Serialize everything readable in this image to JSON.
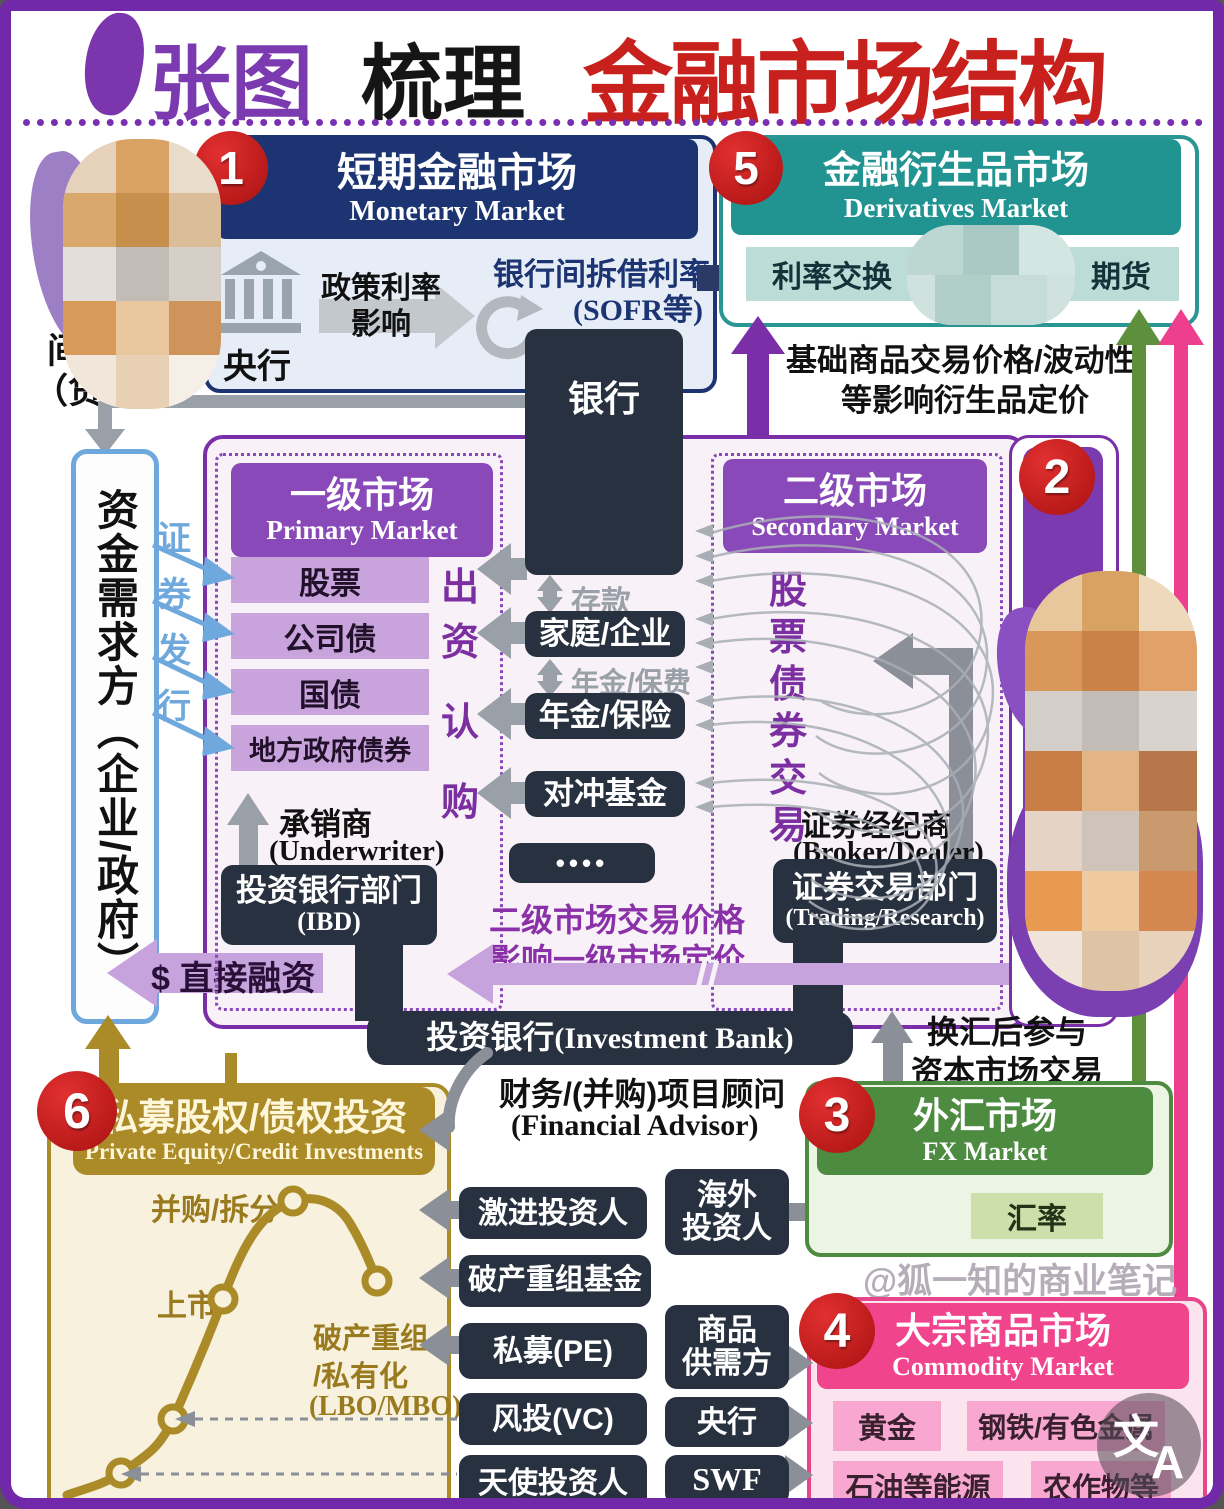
{
  "colors": {
    "frame_purple": "#7229a9",
    "title_red": "#c8201d",
    "title_purple": "#7b3ab0",
    "navy": "#1c3572",
    "teal": "#219492",
    "purple_header": "#8a49b8",
    "deep_purple": "#7b3ab0",
    "badge_red": "#c41d1d",
    "gold": "#ab8a28",
    "green": "#4d8b40",
    "pink": "#f0448c",
    "dark_box": "#28313f",
    "gray_arrow": "#9aa0a8",
    "light_blue": "#6fa8dc",
    "light_purple_arrow": "#c6a3dc"
  },
  "title": {
    "part1": "张图",
    "part2": "梳理",
    "part3": "金融市场结构"
  },
  "monetary": {
    "badge": "1",
    "title_zh": "短期金融市场",
    "title_en": "Monetary Market",
    "central_bank": "央行",
    "policy_line1": "政策利率",
    "policy_line2": "影响",
    "interbank_rate": "银行间拆借利率",
    "interbank_note": "(SOFR等)"
  },
  "bank_box": "银行",
  "derivatives": {
    "badge": "5",
    "title_zh": "金融衍生品市场",
    "title_en": "Derivatives Market",
    "item_irs": "利率交换",
    "item_futures": "期货",
    "note_line1": "基础商品交易价格/波动性",
    "note_line2": "等影响衍生品定价"
  },
  "left_rail": {
    "indirect_line1": "间接融资",
    "indirect_line2": "（贷款）",
    "demand_box": "资金需求方（企业/政府）",
    "issue_chars": [
      "证",
      "券",
      "发",
      "行"
    ],
    "direct_financing": "$ 直接融资"
  },
  "capital": {
    "badge": "2",
    "rail_label": "资本市场",
    "primary": {
      "title_zh": "一级市场",
      "title_en": "Primary Market",
      "instruments": [
        "股票",
        "公司债",
        "国债",
        "地方政府债券"
      ],
      "invest_chars": [
        "出",
        "资",
        "认",
        "购"
      ],
      "underwriter_zh": "承销商",
      "underwriter_en": "(Underwriter)",
      "ibd_zh": "投资银行部门",
      "ibd_en": "(IBD)"
    },
    "secondary": {
      "title_zh": "二级市场",
      "title_en": "Secondary Market",
      "trade_chars": [
        "股",
        "票",
        "债",
        "券",
        "交",
        "易"
      ],
      "broker_zh": "证券经纪商",
      "broker_en": "(Broker/Dealer)",
      "trading_zh": "证券交易部门",
      "trading_en": "(Trading/Research)"
    },
    "institutions": {
      "household": "家庭/企业",
      "pension": "年金/保险",
      "hedge": "对冲基金",
      "others": "••••",
      "deposit": "存款",
      "premium": "年金/保费"
    },
    "pricing_line1": "二级市场交易价格",
    "pricing_line2": "影响一级市场定价",
    "investment_bank_zh": "投资银行",
    "investment_bank_en": "(Investment Bank)",
    "advisor_zh": "财务/(并购)项目顾问",
    "advisor_en": "(Financial Advisor)"
  },
  "fx": {
    "badge": "3",
    "title_zh": "外汇市场",
    "title_en": "FX Market",
    "rate_box": "汇率",
    "note_line1": "换汇后参与",
    "note_line2": "资本市场交易"
  },
  "commodity": {
    "badge": "4",
    "title_zh": "大宗商品市场",
    "title_en": "Commodity Market",
    "items": [
      "黄金",
      "钢铁/有色金属",
      "石油等能源",
      "农作物等"
    ]
  },
  "pe": {
    "badge": "6",
    "title_zh": "私募股权/债权投资",
    "title_en": "Private Equity/Credit Investments",
    "label_ma": "并购/拆分",
    "label_ipo": "上市",
    "label_lbo1": "破产重组",
    "label_lbo2": "/私有化",
    "label_lbo3": "(LBO/MBO)"
  },
  "investors_left": [
    "激进投资人",
    "破产重组基金",
    "私募(PE)",
    "风投(VC)",
    "天使投资人"
  ],
  "investors_right": [
    {
      "line1": "海外",
      "line2": "投资人"
    },
    {
      "line1": "商品",
      "line2": "供需方"
    },
    {
      "line1": "央行",
      "line2": ""
    },
    {
      "line1": "SWF",
      "line2": ""
    }
  ],
  "watermark": "@狐一知的商业笔记",
  "translate_icon": {
    "zh": "文",
    "en": "A"
  }
}
